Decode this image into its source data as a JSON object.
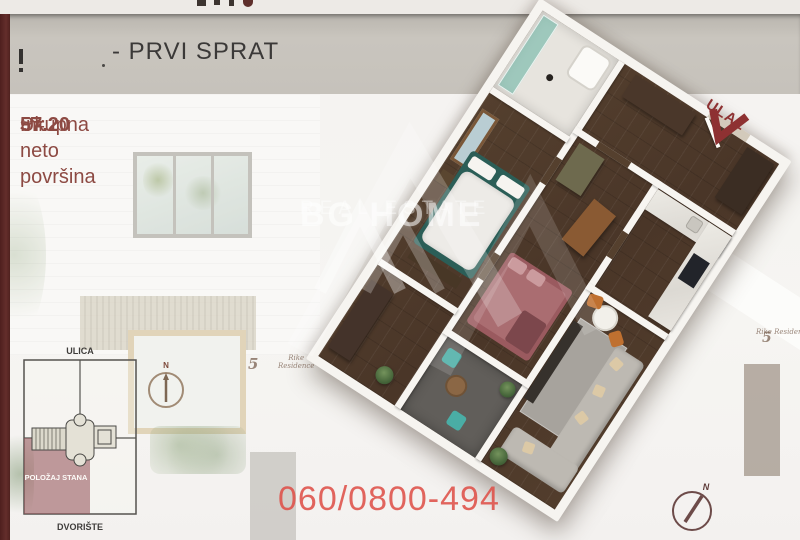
{
  "banner": {
    "title": "- PRVI SPRAT"
  },
  "area": {
    "label": "Ukupna neto površina",
    "prefix": "P=",
    "value": "57.20",
    "unit": "m",
    "exponent": "2"
  },
  "floor_plan": {
    "entrance_label": "ULAZ"
  },
  "site_plan": {
    "street": "ULICA",
    "courtyard": "DVORIŠTE",
    "position": "POLOŽAJ STANA",
    "north": "N"
  },
  "compass": {
    "north": "N"
  },
  "contact": {
    "phone": "060/0800-494"
  },
  "watermark": {
    "line1": "BG HOME",
    "line2": "REAL ESTATE"
  },
  "signage": {
    "script": "Rike Residence",
    "number": "5"
  },
  "colors": {
    "accent_stripe": "#5c2a28",
    "banner_bg": "#c6c2bb",
    "title_text": "#3b3938",
    "area_text": "#8d4a43",
    "phone_red": "#de5048",
    "entrance_red": "#8e3132",
    "site_shade": "#96575b",
    "wall_white": "#f6f4f0",
    "floor_wood": "#4e3a2d",
    "bed_teal": "#2b5e57",
    "daybed_maroon": "#9a5a5f",
    "sofa_gray": "#bdb9b2",
    "chair_orange": "#bf7030",
    "terrace_teal": "#4aada5"
  }
}
